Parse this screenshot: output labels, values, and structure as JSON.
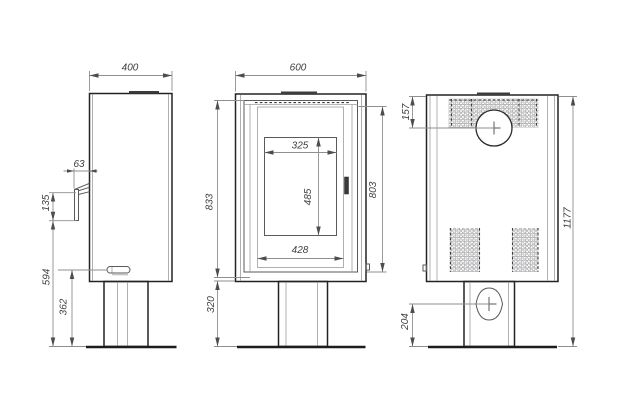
{
  "drawing_type": "stove-technical-dimension-drawing",
  "colors": {
    "background": "#ffffff",
    "outline": "#232323",
    "detail_line": "#5a5a5a",
    "light_line": "#9d9d9d",
    "dimension_line": "#8f8f8f",
    "arrow": "#4d4d4d",
    "text": "#3f3f3f",
    "perforation": "#97979a"
  },
  "dimensions": {
    "side": {
      "width": "400",
      "handle_depth": "63",
      "handle_length": "135",
      "handle_height_from_floor": "594",
      "latch_height_from_floor": "362"
    },
    "front": {
      "width": "600",
      "body_height": "833",
      "door_height": "803",
      "glass_width": "325",
      "glass_height": "485",
      "door_panel_width": "428",
      "base_height": "320"
    },
    "rear": {
      "flue_center_from_top": "157",
      "total_height": "1177",
      "inlet_center_from_floor": "204"
    }
  }
}
